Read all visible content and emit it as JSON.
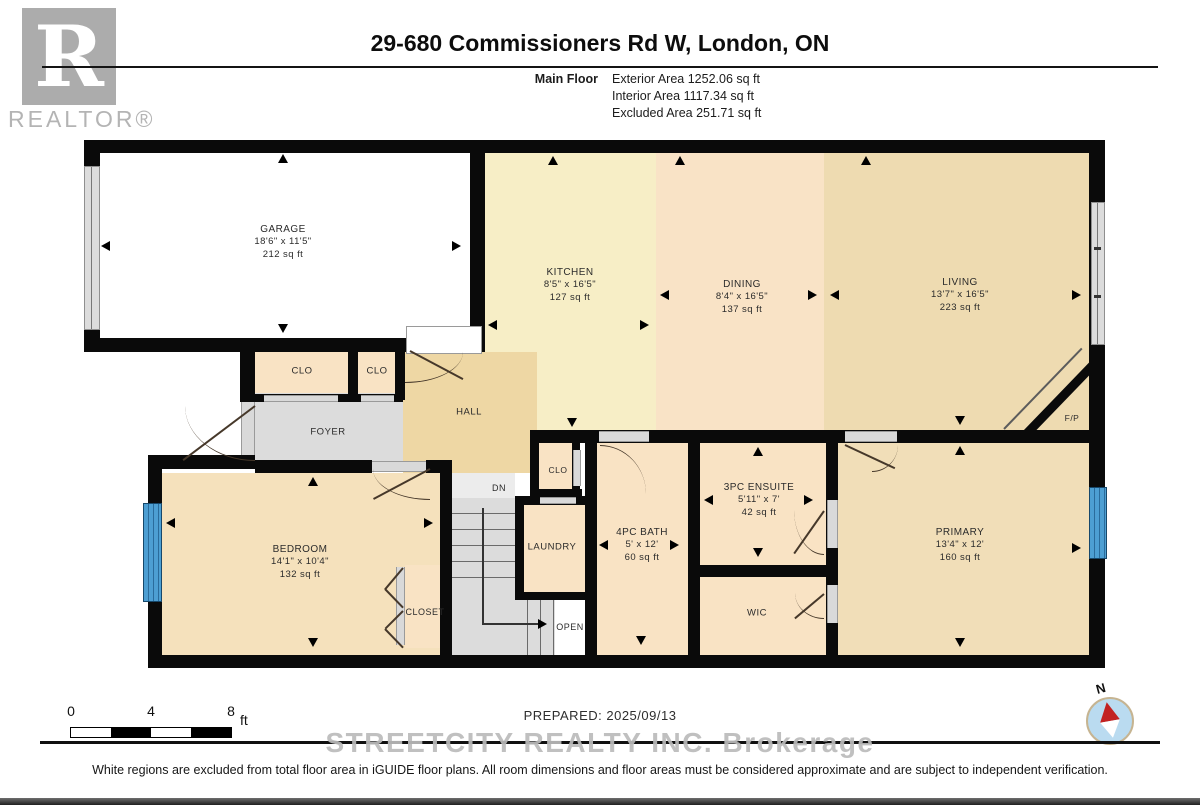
{
  "header": {
    "title": "29-680 Commissioners Rd W, London, ON",
    "floor_label": "Main Floor",
    "stat_exterior": "Exterior Area 1252.06 sq ft",
    "stat_interior": "Interior Area 1117.34 sq ft",
    "stat_excluded": "Excluded Area 251.71 sq ft"
  },
  "logo": {
    "letter": "R",
    "text": "REALTOR®"
  },
  "rooms": {
    "garage": {
      "name": "GARAGE",
      "dims": "18'6\" x 11'5\"",
      "area": "212 sq ft"
    },
    "kitchen": {
      "name": "KITCHEN",
      "dims": "8'5\" x 16'5\"",
      "area": "127 sq ft"
    },
    "dining": {
      "name": "DINING",
      "dims": "8'4\" x 16'5\"",
      "area": "137 sq ft"
    },
    "living": {
      "name": "LIVING",
      "dims": "13'7\" x 16'5\"",
      "area": "223 sq ft"
    },
    "bedroom": {
      "name": "BEDROOM",
      "dims": "14'1\" x 10'4\"",
      "area": "132 sq ft"
    },
    "bath": {
      "name": "4PC BATH",
      "dims": "5' x 12'",
      "area": "60 sq ft"
    },
    "ensuite": {
      "name": "3PC ENSUITE",
      "dims": "5'11\" x 7'",
      "area": "42 sq ft"
    },
    "primary": {
      "name": "PRIMARY",
      "dims": "13'4\" x 12'",
      "area": "160 sq ft"
    }
  },
  "labels": {
    "clo1": "CLO",
    "clo2": "CLO",
    "clo3": "CLO",
    "hall": "HALL",
    "foyer": "FOYER",
    "laundry": "LAUNDRY",
    "closet": "CLOSET",
    "wic": "WIC",
    "open": "OPEN",
    "dn": "DN",
    "fp": "F/P",
    "north": "N"
  },
  "scalebar": {
    "t0": "0",
    "t4": "4",
    "t8": "8",
    "unit": "ft"
  },
  "footer": {
    "prepared": "PREPARED: 2025/09/13",
    "watermark": "STREETCITY REALTY INC.  Brokerage",
    "disclaimer": "White regions are excluded from total floor area in iGUIDE floor plans. All room dimensions and floor areas must be considered approximate and are subject to independent verification."
  },
  "colors": {
    "wall": "#0a0a0a",
    "kitchen": "#f7eec6",
    "dining": "#f9e3c6",
    "living": "#eedbb1",
    "hall": "#eed7a4",
    "peach": "#f9e3c4",
    "bedroom": "#f5e1bc",
    "primary": "#f1deb8",
    "foyer": "#dcdcdc",
    "stairs": "#dcdcdc",
    "window_blue": "#4d9fd3",
    "window_gray": "#dcdcdc",
    "compass_red": "#c22222",
    "compass_blue": "#badbf0"
  }
}
